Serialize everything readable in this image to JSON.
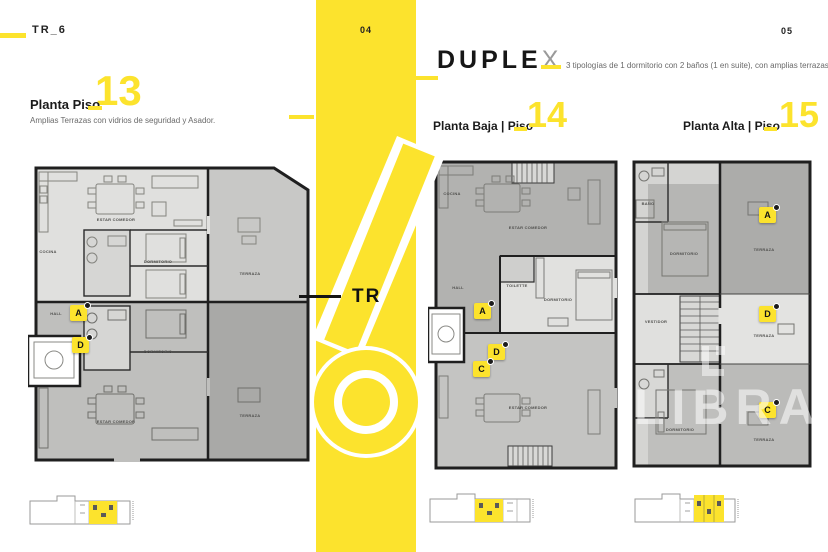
{
  "colors": {
    "accent": "#FCE32D",
    "wall": "#1f1f1f",
    "unit_light": "#E0E0DE",
    "unit_mid": "#BEBEBC",
    "terrace_dark": "#ABABA9",
    "duplex_x_gray": "#9a9a9a"
  },
  "left_page": {
    "doc_code": "TR_6",
    "heading": "Planta Piso",
    "floor_number": "13",
    "subtitle": "Amplias Terrazas con vidrios de seguridad y Asador."
  },
  "center_band": {
    "page_number": "04",
    "tower_prefix": "TR",
    "tower_number": "6"
  },
  "right_page": {
    "page_number": "05",
    "title_main": "DUPLE",
    "title_last": "X",
    "subtitle": "3 tipologías de 1 dormitorio con 2 baños (1 en suite), con amplias terrazas.",
    "plan_baja_title": "Planta Baja | Piso",
    "plan_baja_number": "14",
    "plan_alta_title": "Planta Alta | Piso",
    "plan_alta_number": "15"
  },
  "watermark": {
    "text": "LIBRAND"
  },
  "plan13": {
    "badges": {
      "a": "A",
      "d": "D"
    },
    "labels": [
      {
        "text": "ESTAR COMEDOR"
      },
      {
        "text": "COCINA"
      },
      {
        "text": "DORMITORIO"
      },
      {
        "text": "TERRAZA"
      },
      {
        "text": "HALL"
      },
      {
        "text": "DORMITORIO"
      },
      {
        "text": "ESTAR COMEDOR"
      },
      {
        "text": "TERRAZA"
      }
    ]
  },
  "plan14": {
    "badges": {
      "a": "A",
      "d": "D",
      "c": "C"
    },
    "labels": [
      {
        "text": "COCINA"
      },
      {
        "text": "ESTAR COMEDOR"
      },
      {
        "text": "HALL"
      },
      {
        "text": "TOILETTE"
      },
      {
        "text": "DORMITORIO"
      },
      {
        "text": "ESTAR COMEDOR"
      }
    ]
  },
  "plan15": {
    "badges": {
      "a": "A",
      "d": "D",
      "c": "C"
    },
    "labels": [
      {
        "text": "BAÑO"
      },
      {
        "text": "DORMITORIO"
      },
      {
        "text": "TERRAZA"
      },
      {
        "text": "VESTIDOR"
      },
      {
        "text": "TERRAZA"
      },
      {
        "text": "DORMITORIO"
      },
      {
        "text": "TERRAZA"
      }
    ]
  }
}
